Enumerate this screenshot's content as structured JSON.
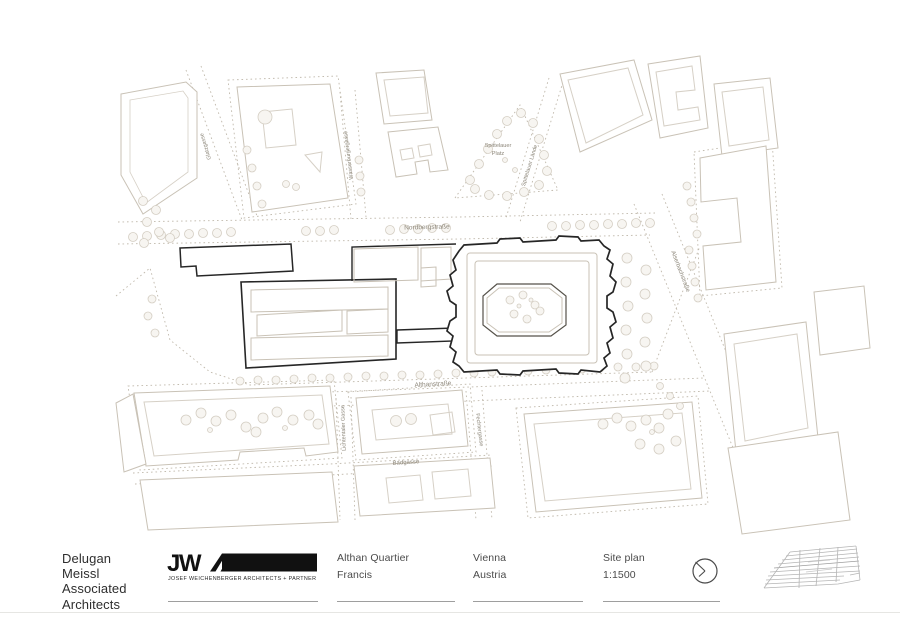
{
  "sheet": {
    "firm_name": "Delugan\nMeissl\nAssociated\nArchitects",
    "logo": {
      "wordmark": "JW",
      "letter_a": "A",
      "caption": "JOSEF WEICHENBERGER ARCHITECTS + PARTNER"
    },
    "project": {
      "name": "Althan Quartier",
      "building": "Francis"
    },
    "location": {
      "city": "Vienna",
      "country": "Austria"
    },
    "drawing": {
      "title": "Site plan",
      "scale": "1:1500"
    },
    "icons": {
      "clock": "clock-icon",
      "building_thumbnail": "building-wireframe-icon"
    }
  },
  "map": {
    "labels": {
      "nordbergstrasse": "Nordbergstraße",
      "althanstrasse": "Althanstraße",
      "badgasse": "Badgasse",
      "wasserburgergasse": "Wasserburgergasse",
      "spittelauer_platz_line1": "Spittelauer",
      "spittelauer_platz_line2": "Platz",
      "spittelauer_laende": "Spittelauer Lände",
      "alserbachstrasse": "Alserbachstraße",
      "lichtentaler_gasse": "Lichtentaler Gasse",
      "fechtergasse": "Fechtergasse",
      "glatzgasse": "Glatzgasse"
    },
    "colors": {
      "building_outline_dark": "#262626",
      "building_outline_light": "#c9c2b6",
      "dotted_boundary": "#c0b9ac",
      "label_text": "#8c8679"
    }
  }
}
